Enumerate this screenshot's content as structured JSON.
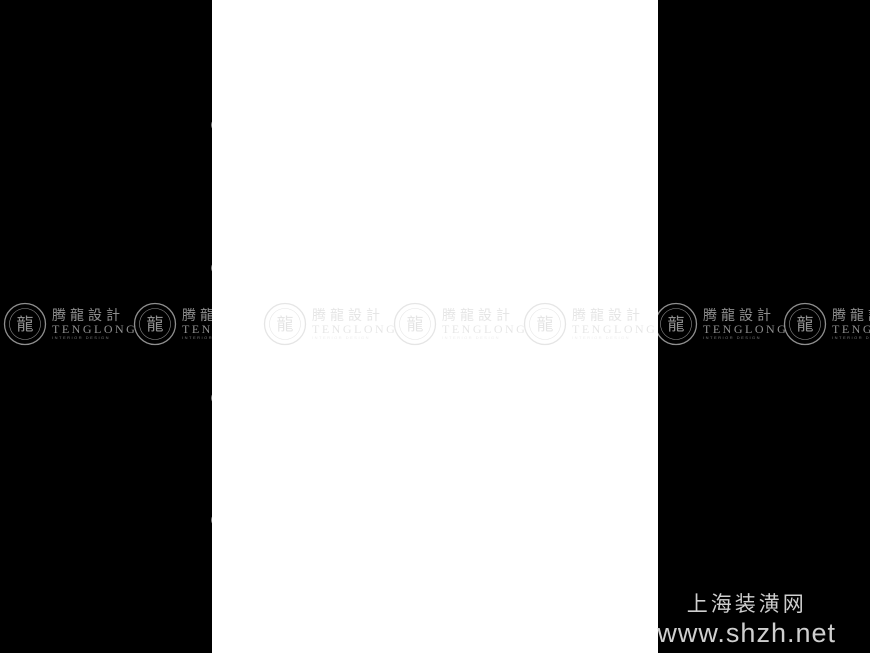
{
  "page": {
    "background": "#000000",
    "sheet_color": "#ffffff"
  },
  "credit": {
    "site_name": "上海装潢网",
    "site_url": "www.shzh.net"
  },
  "watermark": {
    "brand_cn": "腾龍設計",
    "brand_en": "TENGLONG",
    "brand_sub": "INTERIOR DESIGN",
    "seal_glyph": "龍",
    "groups": [
      {
        "layer": "left",
        "x": 3,
        "variant": "dark"
      },
      {
        "layer": "left",
        "x": 133,
        "variant": "dark"
      },
      {
        "layer": "sheet",
        "x": 51,
        "variant": "light"
      },
      {
        "layer": "sheet",
        "x": 181,
        "variant": "light"
      },
      {
        "layer": "sheet",
        "x": 311,
        "variant": "light"
      },
      {
        "layer": "right",
        "x": -4,
        "variant": "dark"
      },
      {
        "layer": "right",
        "x": 125,
        "variant": "dark"
      }
    ]
  },
  "colors": {
    "line": "#8c8c8c",
    "grid": "#d2d2d2",
    "dim": "#9a9a9a",
    "text": "#8a8a8a",
    "column": "#1b1b1b",
    "tag": "#b2b2b2",
    "tagtext": "#9a9a9a",
    "leader": "#d6d6d6"
  },
  "plan": {
    "gridV": [
      {
        "x": 267,
        "y1": 98,
        "y2": 562
      },
      {
        "x": 357,
        "y1": 98,
        "y2": 562
      },
      {
        "x": 427,
        "y1": 98,
        "y2": 562
      },
      {
        "x": 494,
        "y1": 98,
        "y2": 562
      },
      {
        "x": 586,
        "y1": 98,
        "y2": 562
      },
      {
        "x": 408,
        "y1": 395,
        "y2": 562
      },
      {
        "x": 481,
        "y1": 395,
        "y2": 562
      }
    ],
    "gridH": [
      {
        "y": 125,
        "x1": 226,
        "x2": 646
      },
      {
        "y": 181,
        "x1": 226,
        "x2": 646
      },
      {
        "y": 235,
        "x1": 226,
        "x2": 646
      },
      {
        "y": 268,
        "x1": 226,
        "x2": 646
      },
      {
        "y": 292,
        "x1": 226,
        "x2": 646
      },
      {
        "y": 392,
        "x1": 226,
        "x2": 646
      },
      {
        "y": 400,
        "x1": 226,
        "x2": 646
      },
      {
        "y": 530,
        "x1": 226,
        "x2": 646
      }
    ],
    "rooms": [
      [
        247,
        167,
        108,
        96
      ],
      [
        358,
        126,
        60,
        110
      ],
      [
        428,
        126,
        62,
        110
      ],
      [
        496,
        180,
        90,
        110
      ],
      [
        263,
        266,
        92,
        80
      ],
      [
        263,
        346,
        92,
        56
      ],
      [
        403,
        290,
        87,
        105
      ],
      [
        358,
        396,
        120,
        144
      ],
      [
        480,
        396,
        62,
        140
      ]
    ],
    "dwalls": [
      [
        358,
        263,
        358,
        396
      ],
      [
        418,
        289,
        498,
        289
      ]
    ],
    "lines": [
      [
        586,
        186,
        610,
        186
      ],
      [
        610,
        186,
        610,
        232
      ],
      [
        586,
        232,
        610,
        232
      ]
    ],
    "gaps": [
      [
        352,
        178,
        8,
        24
      ],
      [
        433,
        230,
        22,
        7
      ],
      [
        536,
        177,
        28,
        7
      ],
      [
        296,
        399,
        26,
        7
      ],
      [
        424,
        286,
        20,
        8
      ],
      [
        388,
        393,
        26,
        8
      ],
      [
        477,
        428,
        8,
        26
      ],
      [
        425,
        534,
        20,
        8
      ],
      [
        354,
        290,
        8,
        18
      ]
    ],
    "windows": [
      [
        244,
        188,
        6,
        44
      ],
      [
        268,
        164,
        32,
        6
      ],
      [
        310,
        164,
        32,
        6
      ],
      [
        444,
        123,
        30,
        6
      ],
      [
        337,
        452,
        5,
        48
      ],
      [
        538,
        404,
        6,
        28
      ],
      [
        538,
        442,
        6,
        32
      ],
      [
        538,
        482,
        6,
        28
      ],
      [
        380,
        537,
        34,
        6
      ],
      [
        428,
        537,
        34,
        6
      ],
      [
        600,
        186,
        16,
        44
      ],
      [
        600,
        234,
        16,
        36
      ]
    ],
    "columns": [
      [
        245,
        164,
        4,
        7
      ],
      [
        351,
        164,
        4,
        7
      ],
      [
        245,
        256,
        4,
        7
      ],
      [
        351,
        256,
        4,
        7
      ],
      [
        356,
        123,
        7,
        4
      ],
      [
        412,
        123,
        7,
        4
      ],
      [
        427,
        123,
        7,
        4
      ],
      [
        484,
        123,
        7,
        4
      ],
      [
        427,
        229,
        4,
        7
      ],
      [
        484,
        229,
        4,
        7
      ],
      [
        356,
        229,
        4,
        7
      ],
      [
        493,
        177,
        7,
        4
      ],
      [
        579,
        177,
        7,
        4
      ],
      [
        493,
        283,
        4,
        7
      ],
      [
        579,
        283,
        4,
        7
      ],
      [
        261,
        263,
        4,
        7
      ],
      [
        350,
        263,
        4,
        7
      ],
      [
        261,
        340,
        4,
        7
      ],
      [
        350,
        340,
        4,
        7
      ],
      [
        261,
        395,
        4,
        7
      ],
      [
        350,
        395,
        4,
        7
      ],
      [
        401,
        287,
        7,
        4
      ],
      [
        483,
        287,
        7,
        4
      ],
      [
        401,
        388,
        7,
        4
      ],
      [
        483,
        388,
        7,
        4
      ],
      [
        356,
        393,
        7,
        4
      ],
      [
        471,
        393,
        7,
        4
      ],
      [
        477,
        393,
        7,
        4
      ],
      [
        535,
        393,
        7,
        4
      ],
      [
        356,
        533,
        7,
        4
      ],
      [
        471,
        533,
        7,
        4
      ],
      [
        477,
        529,
        7,
        4
      ],
      [
        535,
        529,
        7,
        4
      ],
      [
        415,
        287,
        4,
        7
      ]
    ],
    "stair": {
      "x1": 361,
      "x2": 414,
      "yTop": 160,
      "step": 7,
      "count": 10,
      "stringer": [
        389,
        157,
        6,
        76
      ],
      "diag": [
        362,
        212,
        391,
        171
      ],
      "door": [
        357,
        199,
        4,
        13
      ],
      "arrow": {
        "x": 377,
        "y1": 228,
        "y2": 198
      }
    },
    "bay": {
      "outer": [
        [
          358,
          429
        ],
        [
          337,
          447
        ],
        [
          337,
          505
        ],
        [
          358,
          523
        ]
      ],
      "inner": [
        [
          358,
          435
        ],
        [
          342,
          450
        ],
        [
          342,
          502
        ],
        [
          358,
          517
        ]
      ]
    },
    "counter": [
      272,
      339,
      60,
      6
    ],
    "dimsH": [
      {
        "y": 101,
        "x1": 247,
        "x2": 612,
        "ticks": [
          247,
          267,
          357,
          427,
          494,
          586,
          612
        ],
        "labs": [
          [
            257,
            "740"
          ],
          [
            312,
            "3300"
          ],
          [
            392,
            "2580"
          ],
          [
            460,
            "2460"
          ],
          [
            540,
            "3380"
          ],
          [
            599,
            "960"
          ]
        ]
      },
      {
        "y": 107,
        "x1": 247,
        "x2": 612,
        "ticks": [
          247,
          307,
          357,
          390,
          427,
          460,
          494,
          540,
          586,
          612
        ],
        "labs": []
      },
      {
        "y": 176,
        "x1": 250,
        "x2": 355,
        "ticks": [
          250,
          285,
          320,
          355
        ],
        "labs": []
      },
      {
        "y": 545,
        "x1": 250,
        "x2": 612,
        "ticks": [
          250,
          263,
          312,
          361,
          408,
          440,
          481,
          540,
          612
        ],
        "labs": []
      },
      {
        "y": 552,
        "x1": 250,
        "x2": 612,
        "ticks": [
          250,
          361,
          481,
          612
        ],
        "labs": [
          [
            305,
            "4080"
          ],
          [
            420,
            "4420"
          ],
          [
            545,
            "4780"
          ]
        ]
      },
      {
        "y": 559,
        "x1": 250,
        "x2": 612,
        "ticks": [
          250,
          612
        ],
        "labs": [
          [
            430,
            "13280"
          ]
        ]
      }
    ],
    "dimsV": [
      {
        "x": 228,
        "y1": 125,
        "y2": 530,
        "ticks": [
          125,
          268,
          398,
          530
        ],
        "labs": [
          [
            196,
            "5280"
          ],
          [
            333,
            "4760"
          ],
          [
            464,
            "4840"
          ]
        ]
      },
      {
        "x": 236,
        "y1": 125,
        "y2": 530,
        "ticks": [
          125,
          530
        ],
        "labs": [
          [
            327,
            "14880"
          ]
        ]
      },
      {
        "x": 633,
        "y1": 124,
        "y2": 534,
        "ticks": [
          124,
          181,
          235,
          292,
          392,
          534
        ],
        "labs": [
          [
            152,
            "2080"
          ],
          [
            208,
            "1980"
          ],
          [
            263,
            "2090"
          ],
          [
            342,
            "3660"
          ],
          [
            463,
            "5230"
          ]
        ]
      },
      {
        "x": 640,
        "y1": 124,
        "y2": 534,
        "ticks": [
          124,
          534
        ],
        "labs": [
          [
            329,
            "14880"
          ]
        ]
      }
    ],
    "bubbles": [
      {
        "x": 267,
        "y": 91,
        "label": "C"
      },
      {
        "x": 357,
        "y": 91,
        "label": "D"
      },
      {
        "x": 427,
        "y": 91,
        "label": "E"
      },
      {
        "x": 494,
        "y": 91,
        "label": "H"
      },
      {
        "x": 586,
        "y": 92,
        "label": "K"
      },
      {
        "x": 263,
        "y": 573,
        "label": "C"
      },
      {
        "x": 361,
        "y": 574,
        "label": "D"
      },
      {
        "x": 408,
        "y": 573,
        "label": "E"
      },
      {
        "x": 481,
        "y": 574,
        "label": "G"
      },
      {
        "x": 218,
        "y": 125,
        "label": "1"
      },
      {
        "x": 218,
        "y": 268,
        "label": "5"
      },
      {
        "x": 218,
        "y": 398,
        "label": "9"
      },
      {
        "x": 218,
        "y": 520,
        "label": "10"
      },
      {
        "x": 650,
        "y": 124,
        "label": "1"
      },
      {
        "x": 651,
        "y": 181,
        "label": "3"
      },
      {
        "x": 651,
        "y": 235,
        "label": "4"
      },
      {
        "x": 649,
        "y": 292,
        "label": "6"
      },
      {
        "x": 648,
        "y": 392,
        "label": "8"
      },
      {
        "x": 650,
        "y": 534,
        "label": "10"
      }
    ],
    "tagPool": [
      "C0915",
      "M0921",
      "C1518",
      "M0821",
      "C0924",
      "C1515",
      "M1021",
      "C0615"
    ],
    "tagsTop": [
      {
        "x": 277,
        "n": 2
      },
      {
        "x": 331,
        "n": 3
      },
      {
        "x": 399,
        "n": 1
      },
      {
        "x": 447,
        "n": 3
      },
      {
        "x": 522,
        "n": 3
      },
      {
        "x": 598,
        "n": 3
      }
    ],
    "tagsBottom": [
      {
        "x": 244,
        "n": 2
      },
      {
        "x": 299,
        "n": 3
      },
      {
        "x": 325,
        "n": 3
      },
      {
        "x": 371,
        "n": 3
      },
      {
        "x": 420,
        "n": 2
      },
      {
        "x": 447,
        "n": 3
      },
      {
        "x": 489,
        "n": 2
      },
      {
        "x": 527,
        "n": 3
      }
    ],
    "roomLabels": [
      {
        "x": 303,
        "y": 215,
        "s": "-3.050"
      },
      {
        "x": 455,
        "y": 185,
        "s": "-3.050"
      },
      {
        "x": 540,
        "y": 235,
        "s": "-2.800"
      },
      {
        "x": 308,
        "y": 305,
        "s": "-2.800"
      },
      {
        "x": 303,
        "y": 372,
        "s": "-2.800"
      },
      {
        "x": 448,
        "y": 340,
        "s": "-2.800"
      },
      {
        "x": 385,
        "y": 320,
        "s": "-2.800"
      },
      {
        "x": 380,
        "y": 248,
        "s": "-2.800"
      },
      {
        "x": 415,
        "y": 465,
        "s": "-2.800"
      },
      {
        "x": 508,
        "y": 462,
        "s": "-2.800"
      }
    ],
    "arrows": [
      {
        "x": 462,
        "y": 293,
        "a": 180
      },
      {
        "x": 377,
        "y": 199,
        "a": -90
      },
      {
        "x": 442,
        "y": 174,
        "a": -60
      }
    ]
  }
}
